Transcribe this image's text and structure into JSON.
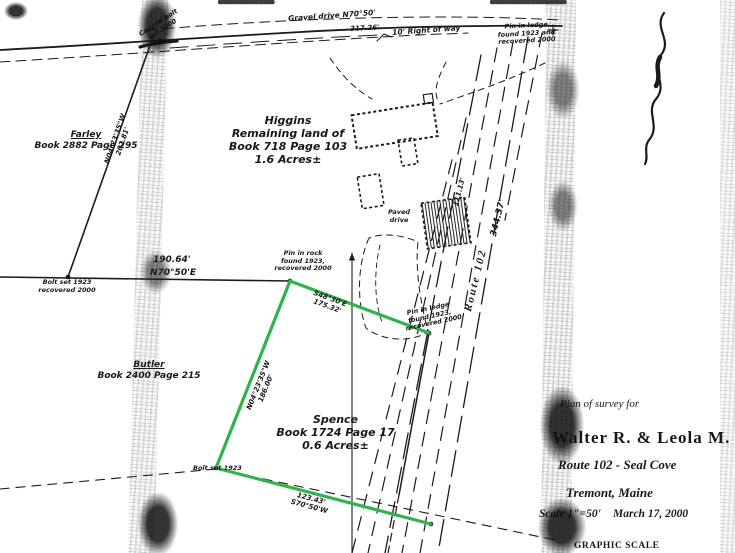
{
  "title_block": {
    "plan_of": "Plan of survey for",
    "owner": "Walter R. & Leola M. Higgins",
    "route": "Route 102 - Seal Cove",
    "town": "Tremont, Maine",
    "scale": "Scale 1\"=50'",
    "date": "March 17, 2000",
    "graphic_scale": "GRAPHIC SCALE"
  },
  "parcels": {
    "higgins": [
      "Higgins",
      "Remaining land of",
      "Book 718 Page 103",
      "1.6 Acres±"
    ],
    "spence": [
      "Spence",
      "Book 1724 Page 17",
      "0.6 Acres±"
    ],
    "farley": [
      "Farley",
      "Book 2882 Page 295"
    ],
    "butler": [
      "Butler",
      "Book 2400 Page 215"
    ]
  },
  "bearings": {
    "north_line_dist": "190.64'",
    "north_line_brg": "N70°50'E",
    "farley_line": [
      "N04°23'35\"W",
      "202.81'"
    ],
    "spence_west": [
      "N04°23'35\"W",
      "186.00'"
    ],
    "spence_north": [
      "S48°30'E",
      "175.32'"
    ],
    "spence_south": [
      "123.43'",
      "S70°50'W"
    ],
    "route_name": "Route 102",
    "route_dist": "344.37'",
    "route_dist2": "111.13'",
    "row_dist": "317.26'",
    "gravel_drive": "Gravel drive  N70°50'",
    "right_of_way": "10' Right of way"
  },
  "notes": {
    "bolt_nw": [
      "Bolt set 1923",
      "recovered 2000"
    ],
    "pin_rock": [
      "Pin in rock",
      "found 1923,",
      "recovered 2000"
    ],
    "pin_ledge_top": [
      "Pin in ledge",
      "found 1923 and",
      "recovered 2000"
    ],
    "pin_ledge_mid": [
      "Pin in ledge",
      "found 1923,",
      "recovered 2000"
    ],
    "bolt_sw": "Bolt set 1923",
    "capped_bolt": [
      "Capped bolt",
      "set 2000"
    ],
    "paved_drive": [
      "Paved",
      "drive"
    ]
  },
  "colors": {
    "ink": "#1b1b1b",
    "highlight_green": "#2fb34c",
    "scan_band": "#8a8a8a"
  }
}
